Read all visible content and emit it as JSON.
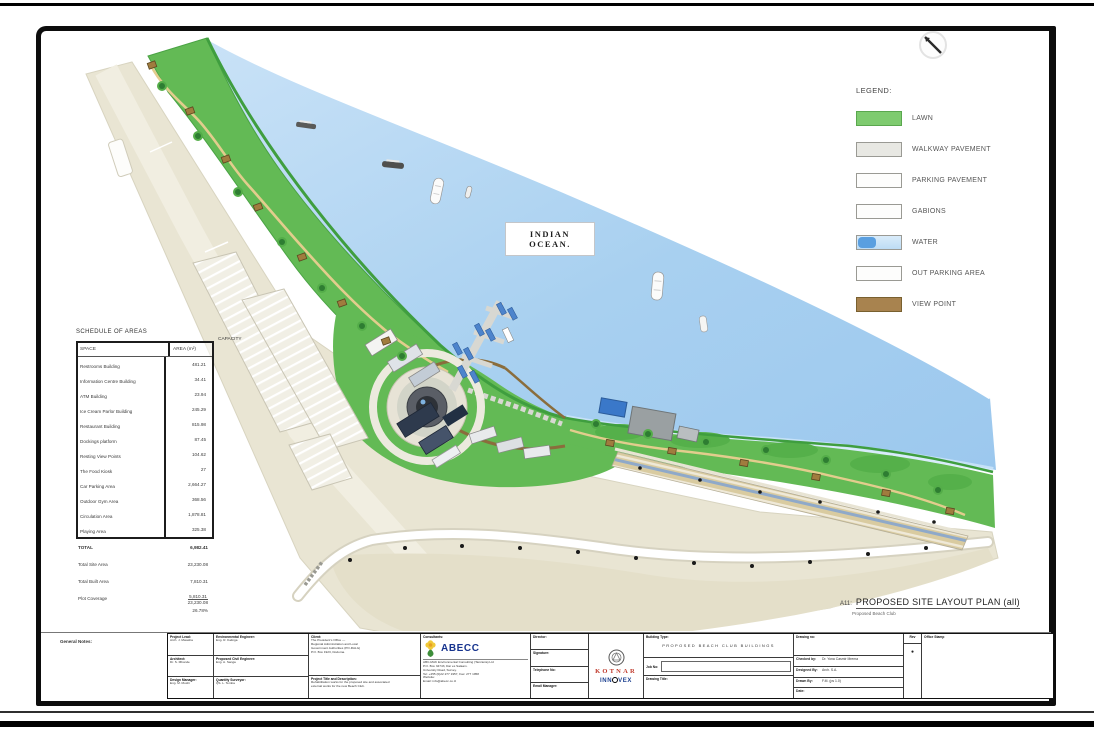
{
  "ocean_label_line1": "INDIAN",
  "ocean_label_line2": "OCEAN.",
  "legend": {
    "title": "LEGEND:",
    "items": [
      {
        "label": "LAWN",
        "swatch": "lawn",
        "color": "#7ecb6f"
      },
      {
        "label": "WALKWAY PAVEMENT",
        "swatch": "walkway",
        "color": "#e8e8e3"
      },
      {
        "label": "PARKING PAVEMENT",
        "swatch": "parking",
        "color": "#fdfdfc"
      },
      {
        "label": "GABIONS",
        "swatch": "gabions",
        "color": "#fdfdfc"
      },
      {
        "label": "WATER",
        "swatch": "water",
        "color": "#bddcf5"
      },
      {
        "label": "OUT PARKING AREA",
        "swatch": "out-parking",
        "color": "#fdfdfc"
      },
      {
        "label": "VIEW POINT",
        "swatch": "view-point",
        "color": "#a8834f"
      }
    ]
  },
  "schedule": {
    "title": "SCHEDULE OF AREAS",
    "col_space": "SPACE",
    "col_area": "AREA (m²)",
    "col_capacity": "CAPACITY",
    "rows": [
      {
        "space": "Restrooms Building",
        "area": "481.21"
      },
      {
        "space": "Information Centre Building",
        "area": "34.41"
      },
      {
        "space": "ATM Building",
        "area": "23.94"
      },
      {
        "space": "Ice Cream Parlor Building",
        "area": "245.29"
      },
      {
        "space": "Restaurant Building",
        "area": "815.98"
      },
      {
        "space": "Dockings platform",
        "area": "87.45"
      },
      {
        "space": "Resting View Points",
        "area": "104.62"
      },
      {
        "space": "The Food Kiosk",
        "area": "27"
      },
      {
        "space": "Car Parking Area",
        "area": "2,664.27"
      },
      {
        "space": "Outdoor Gym Area",
        "area": "368.56"
      },
      {
        "space": "Circulation Area",
        "area": "1,878.81"
      },
      {
        "space": "Playing Area",
        "area": "325.38"
      }
    ],
    "summary": [
      {
        "space": "TOTAL",
        "area": "6,982.41",
        "total": true
      },
      {
        "space": "Total Site Area",
        "area": "23,230.08"
      },
      {
        "space": "Total Built Area",
        "area": "7,810.31"
      },
      {
        "space": "Plot Coverage",
        "area": "5,810.31 / 23,230.08",
        "pct": "26.78%"
      }
    ]
  },
  "caption": {
    "prefix": "A11:",
    "title": "PROPOSED SITE LAYOUT PLAN (all)",
    "subtitle": "Proposed Beach Club"
  },
  "title_block": {
    "general_notes_label": "General Notes:",
    "staff_col1": [
      "Project Lead:",
      "Arch. J. Mwasha",
      "Architect:",
      "Dr. S. Mbonde",
      "Design Manager:",
      "Eng. M. Mushi"
    ],
    "staff_col2": [
      "Environmental Engineer:",
      "Eng. R. Kalinga",
      "Proposed Civil Engineer:",
      "Eng. A. Sanga",
      "Quantity Surveyor:",
      "QS. L. Temba"
    ],
    "client_label": "Client:",
    "client_lines": [
      "The President's Office —",
      "Regional Administration and Local",
      "Government Authorities (PO-RALG)",
      "P.O. Box 1923, Dodoma."
    ],
    "project_label": "Project Title and Description:",
    "project_lines": [
      "Rehabilitation works for the proposed site and associated",
      "external works for the new Beach Club."
    ],
    "consultant_label": "Consultants:",
    "consultant_name": "ABECC",
    "consultant_lines": [
      "ABC-MAK Environmental Consulting (Tanzania) Ltd",
      "P.O. Box 34743, Dar es Salaam.",
      "University Road, Survey.",
      "Tel: +255 (0)22 277 1957, Fax: 277 1958",
      "Website:",
      "Email: info@abecc.co.tz"
    ],
    "director_rows": [
      "Director:",
      "Signature:",
      "Telephone No:",
      "Email Manager:"
    ],
    "brand_red": "KOTNAR",
    "brand_blue_pre": "INN",
    "brand_blue_post": "VEX",
    "building_type_label": "Building Type:",
    "building_type_value": "PROPOSED BEACH CLUB BUILDINGS",
    "job_no_label": "Job No:",
    "drawing_title_label": "Drawing Title:",
    "drawing_no_label": "Drawing no:",
    "rev_label": "Rev",
    "rev_value": "●",
    "office_stamp_label": "Office Stamp",
    "check_rows": [
      {
        "label": "Checked by:",
        "value": "Dr. Yona Casmir Mrema"
      },
      {
        "label": "Designed By:",
        "value": "Arch. S.A."
      },
      {
        "label": "Drawn By:",
        "value": "F.M. (ps 1.0)"
      },
      {
        "label": "Date:",
        "value": ""
      }
    ]
  },
  "colors": {
    "water": "#aed4f2",
    "lawn": "#63ba55",
    "land": "#e9e5d3",
    "view_point": "#a07c3e",
    "accent_red": "#c0392b",
    "accent_blue": "#16338e"
  }
}
